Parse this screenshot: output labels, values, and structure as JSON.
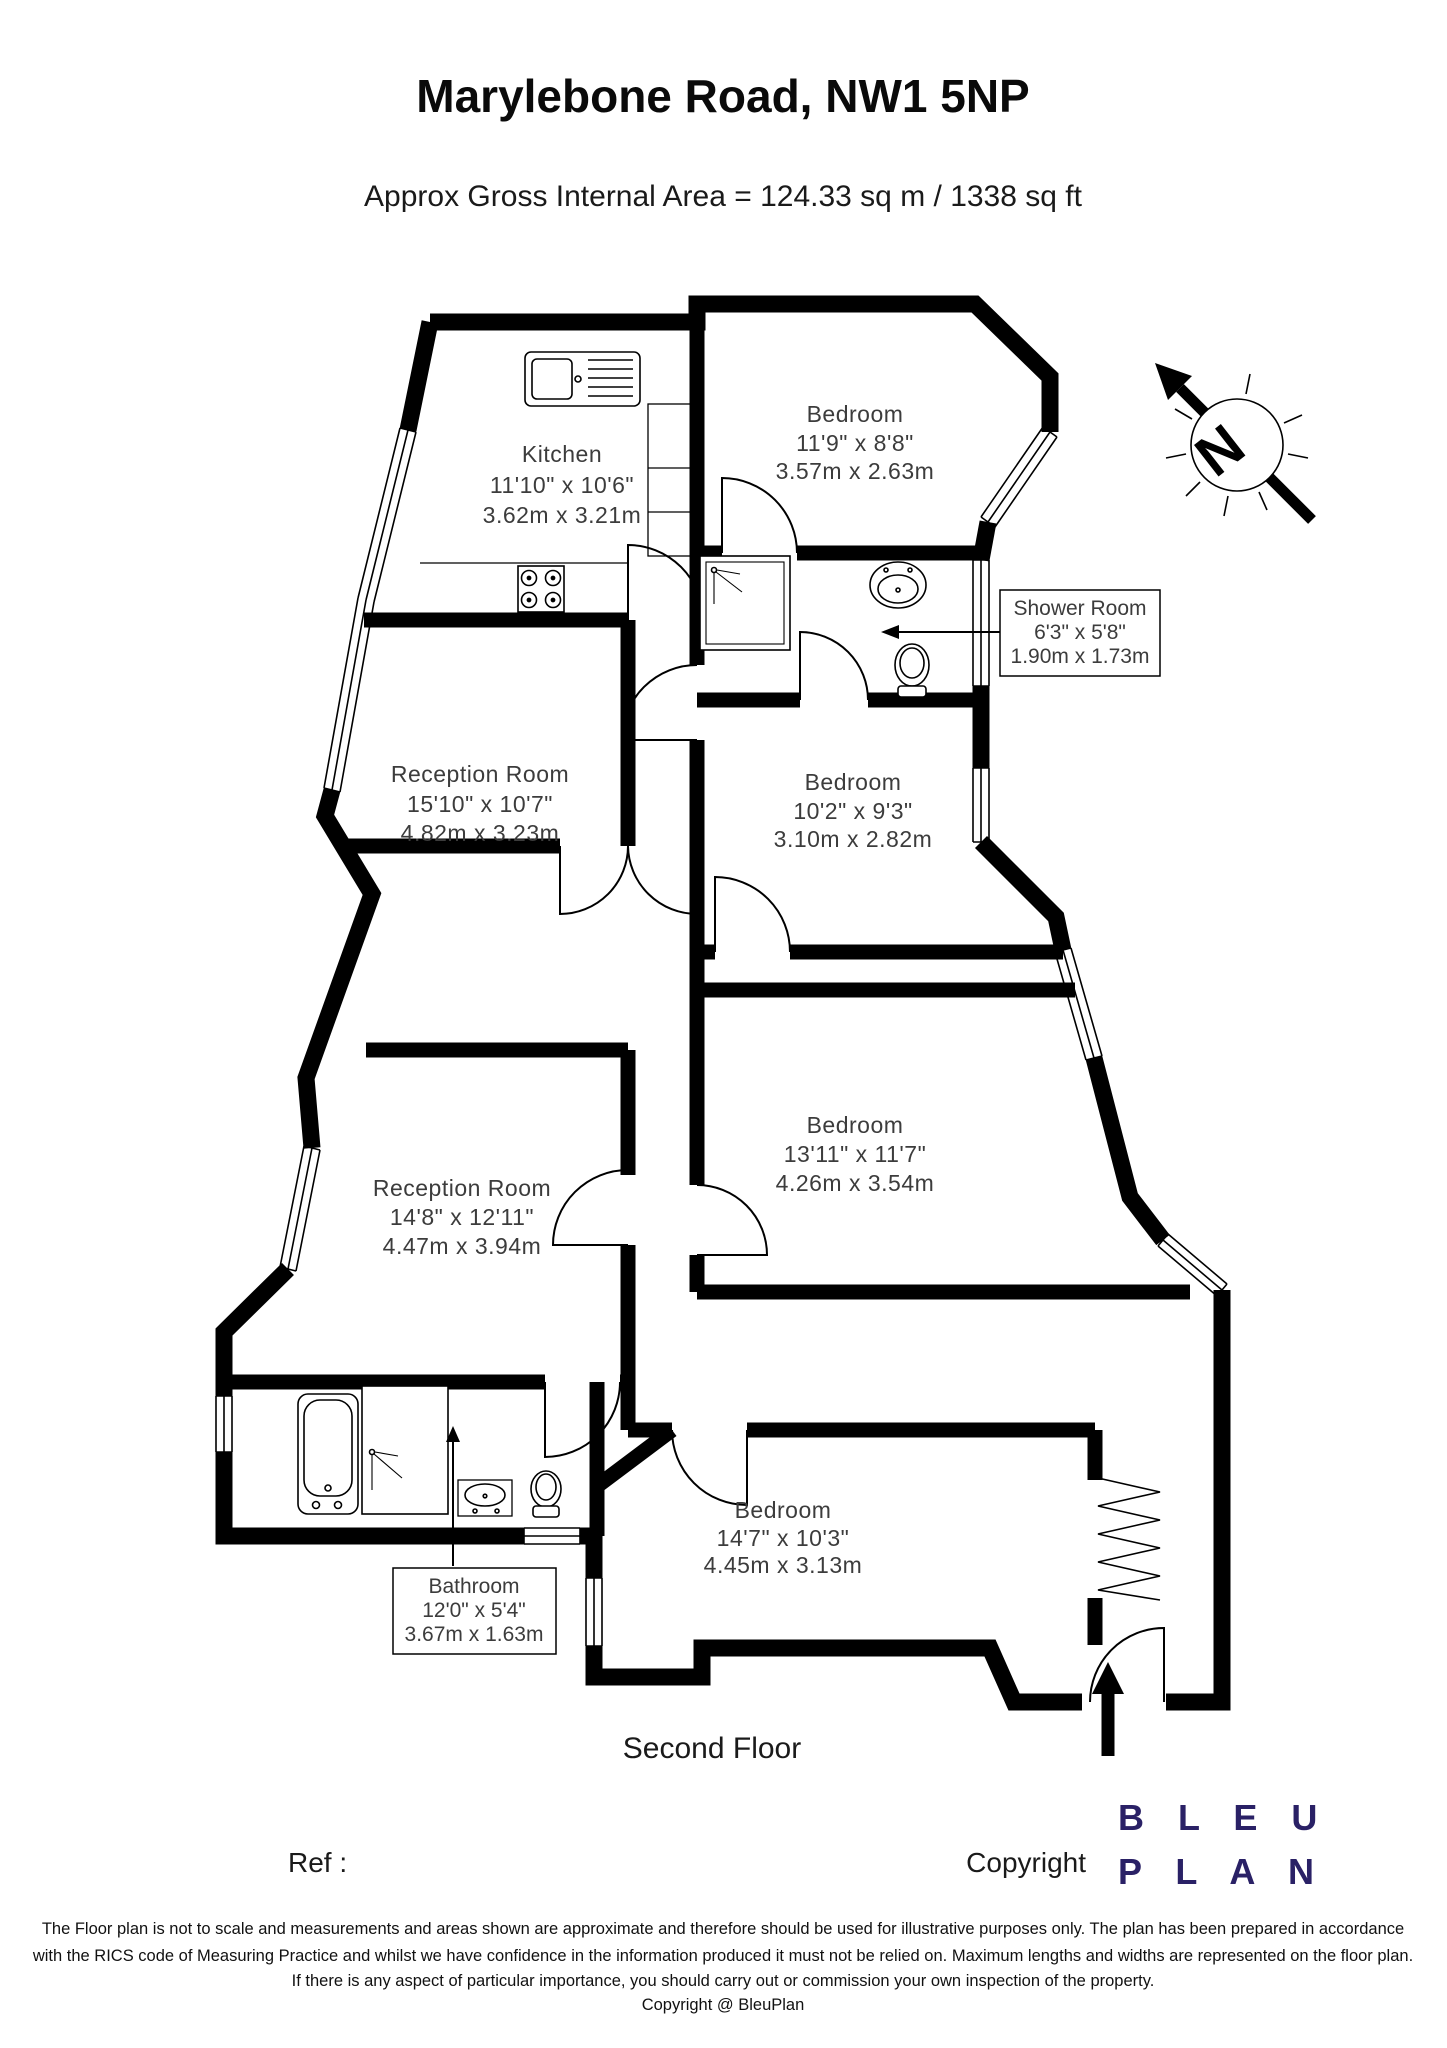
{
  "header": {
    "title": "Marylebone Road, NW1 5NP",
    "subtitle": "Approx Gross Internal Area = 124.33 sq m / 1338 sq ft"
  },
  "rooms": {
    "kitchen": {
      "name": "Kitchen",
      "imperial": "11'10\" x 10'6\"",
      "metric": "3.62m x 3.21m"
    },
    "bedroom_top": {
      "name": "Bedroom",
      "imperial": "11'9\" x 8'8\"",
      "metric": "3.57m x 2.63m"
    },
    "shower_room": {
      "name": "Shower Room",
      "imperial": "6'3\" x 5'8\"",
      "metric": "1.90m x 1.73m"
    },
    "reception_room_1": {
      "name": "Reception Room",
      "imperial": "15'10\" x 10'7\"",
      "metric": "4.82m x 3.23m"
    },
    "bedroom_middle": {
      "name": "Bedroom",
      "imperial": "10'2\" x 9'3\"",
      "metric": "3.10m x 2.82m"
    },
    "bedroom_large": {
      "name": "Bedroom",
      "imperial": "13'11\" x 11'7\"",
      "metric": "4.26m x 3.54m"
    },
    "reception_room_2": {
      "name": "Reception Room",
      "imperial": "14'8\" x 12'11\"",
      "metric": "4.47m x 3.94m"
    },
    "bathroom": {
      "name": "Bathroom",
      "imperial": "12'0\" x 5'4\"",
      "metric": "3.67m x 1.63m"
    },
    "bedroom_bottom": {
      "name": "Bedroom",
      "imperial": "14'7\" x 10'3\"",
      "metric": "4.45m x 3.13m"
    }
  },
  "compass": {
    "letter": "N"
  },
  "floor_label": "Second Floor",
  "footer": {
    "ref_label": "Ref  :",
    "copyright_label": "Copyright",
    "brand_line1": "B L E U",
    "brand_line2": "P L A N",
    "brand_color": "#2a2166"
  },
  "disclaimer": {
    "line1": "The Floor plan is not to scale and measurements and areas shown are approximate and therefore should be used for illustrative purposes only. The plan has been prepared in accordance",
    "line2": "with the RICS code of Measuring Practice and whilst we have confidence in the information produced it must not be relied on. Maximum lengths and widths are represented on the floor plan.",
    "line3": "If there is any aspect of particular importance, you should carry out or commission your own inspection of the property.",
    "line4": "Copyright @ BleuPlan"
  }
}
